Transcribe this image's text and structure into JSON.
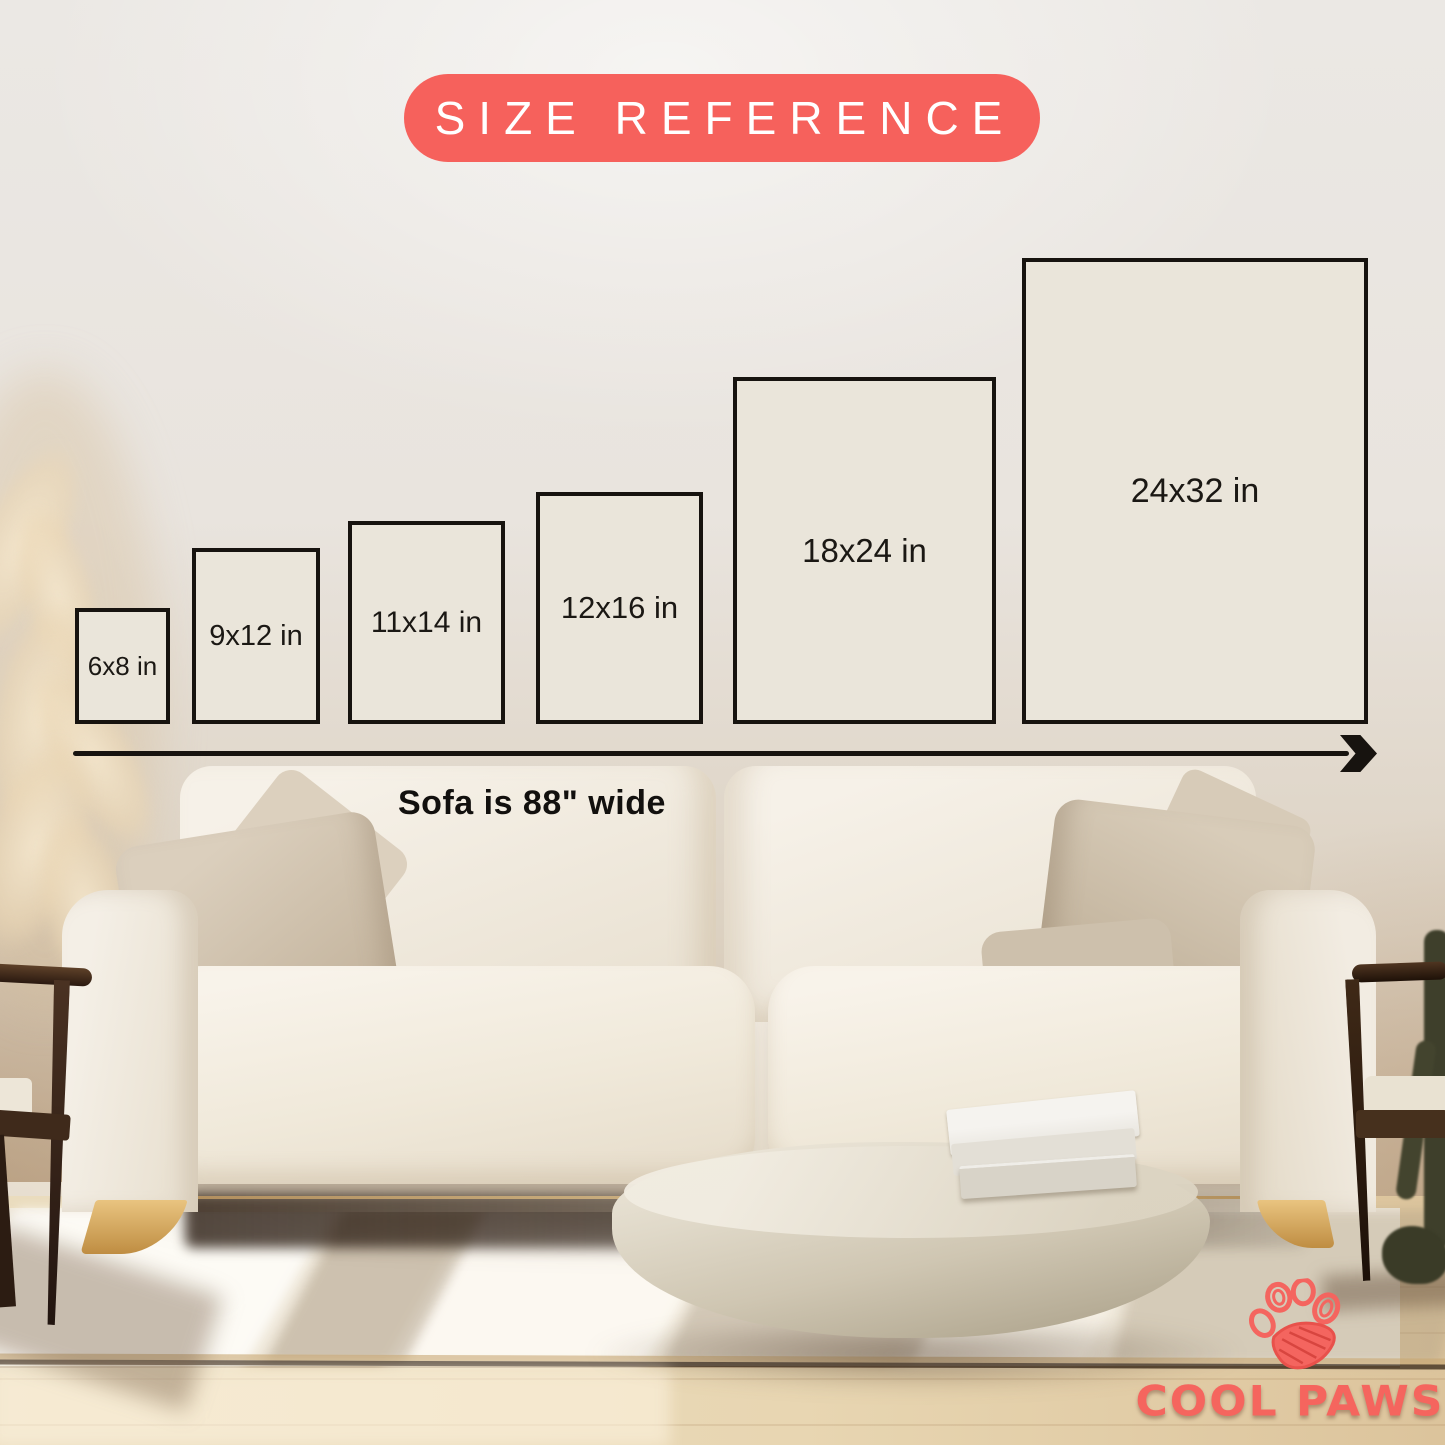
{
  "title_badge": {
    "label": "SIZE REFERENCE"
  },
  "sizes": [
    {
      "label": "6x8 in",
      "width_in": 6,
      "height_in": 8
    },
    {
      "label": "9x12 in",
      "width_in": 9,
      "height_in": 12
    },
    {
      "label": "11x14 in",
      "width_in": 11,
      "height_in": 14
    },
    {
      "label": "12x16 in",
      "width_in": 12,
      "height_in": 16
    },
    {
      "label": "18x24 in",
      "width_in": 18,
      "height_in": 24
    },
    {
      "label": "24x32 in",
      "width_in": 24,
      "height_in": 32
    }
  ],
  "scale_note": {
    "text": "Sofa is 88\" wide"
  },
  "brand": {
    "name": "COOL PAWS",
    "icon": "paw-print"
  },
  "colors": {
    "badge_bg": "#F6615C",
    "badge_text": "#FFFFFF",
    "frame_fill": "#EAE5DA",
    "frame_border": "#17130F",
    "logo_accent": "#F4655F"
  }
}
